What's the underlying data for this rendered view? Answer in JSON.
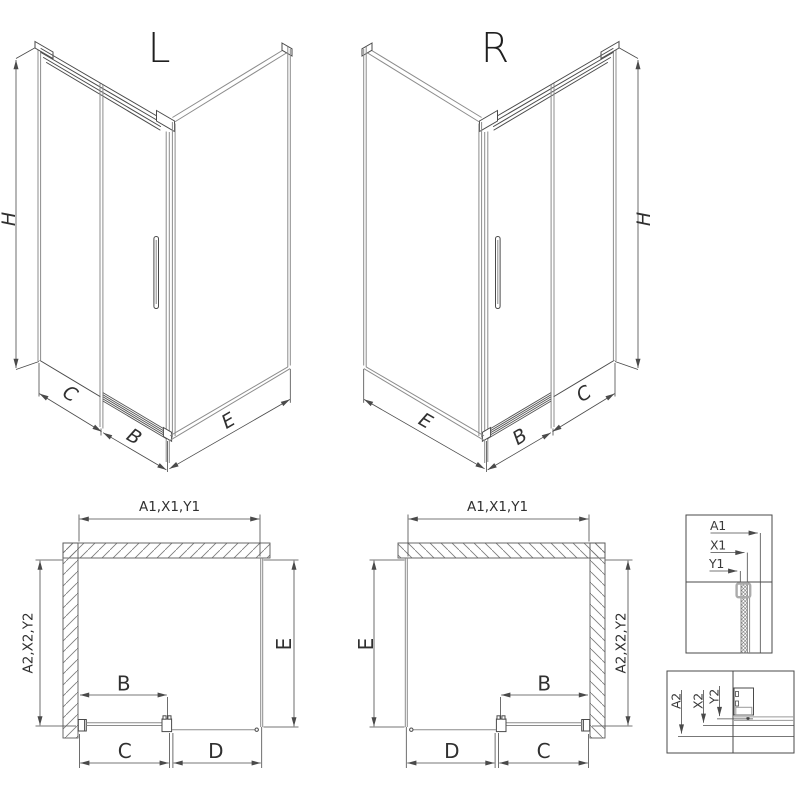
{
  "diagram": {
    "iso_left": {
      "title": "L",
      "dim_h": "H",
      "dim_c": "C",
      "dim_b": "B",
      "dim_e": "E"
    },
    "iso_right": {
      "title": "R",
      "dim_h": "H",
      "dim_c": "C",
      "dim_b": "B",
      "dim_e": "E"
    },
    "plan_left": {
      "dim_top": "A1,X1,Y1",
      "dim_side_wall": "A2,X2,Y2",
      "dim_side_glass": "E",
      "dim_b": "B",
      "dim_c": "C",
      "dim_d": "D"
    },
    "plan_right": {
      "dim_top": "A1,X1,Y1",
      "dim_side_wall": "A2,X2,Y2",
      "dim_side_glass": "E",
      "dim_b": "B",
      "dim_c": "C",
      "dim_d": "D"
    },
    "detail_top": {
      "dim_a": "A1",
      "dim_x": "X1",
      "dim_y": "Y1"
    },
    "detail_bottom": {
      "dim_a": "A2",
      "dim_x": "X2",
      "dim_y": "Y2"
    }
  },
  "colors": {
    "background": "#ffffff",
    "line": "#4a4a4a",
    "glass_line": "#8c8c8c",
    "text": "#303030",
    "detail_highlight": "#ababab"
  }
}
